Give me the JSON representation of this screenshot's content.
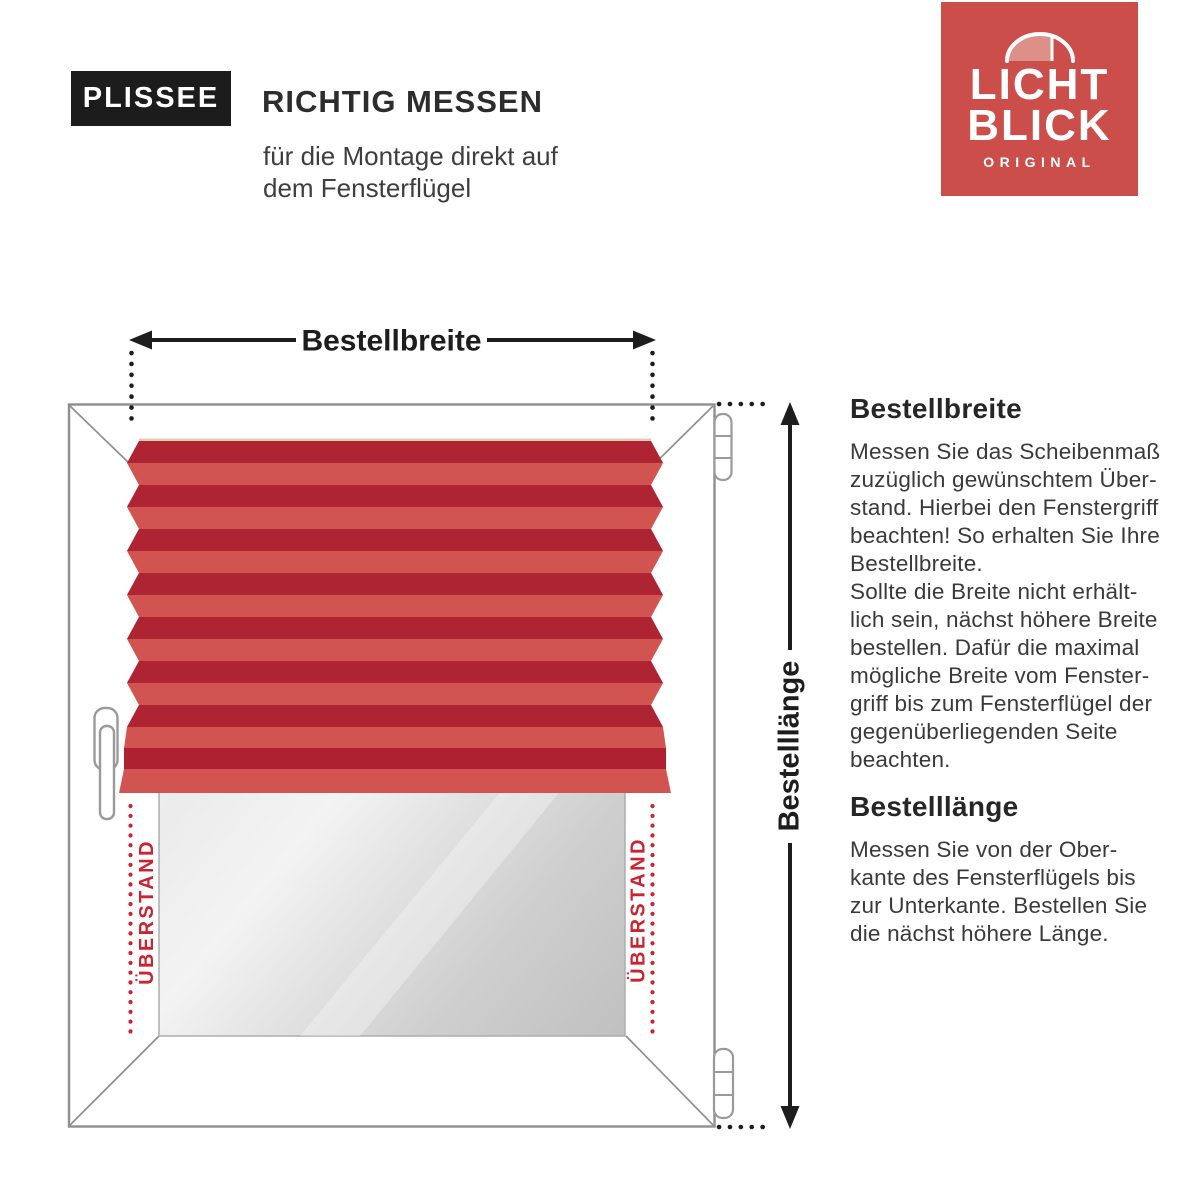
{
  "header": {
    "badge": "PLISSEE",
    "title": "RICHTIG MESSEN",
    "subtitle_lines": [
      "für die Montage direkt auf",
      "dem Fensterflügel"
    ]
  },
  "logo": {
    "word1": "LICHT",
    "word2": "BLICK",
    "tagline": "ORIGINAL",
    "bg_color": "#cb4e4a",
    "awning_color": "#dd9087"
  },
  "diagram": {
    "width_arrow_label": "Bestellbreite",
    "length_arrow_label": "Bestelllänge",
    "overhang_left_label": "ÜBERSTAND",
    "overhang_right_label": "ÜBERSTAND",
    "colors": {
      "pleat_dark": "#af2433",
      "pleat_light": "#d25450",
      "overhang_red": "#cb2430",
      "frame_gray": "#8f8f8f",
      "arrow_black": "#1d1d1d",
      "glass_light": "#f6f6f6",
      "glass_dark": "#c0c0c0"
    }
  },
  "sections": [
    {
      "heading": "Bestellbreite",
      "lines": [
        "Messen Sie das Scheibenmaß",
        "zuzüglich gewünschtem Über-",
        "stand. Hierbei den Fenstergriff",
        "beachten! So erhalten Sie Ihre",
        "Bestellbreite.",
        "Sollte die Breite nicht erhält-",
        "lich sein, nächst höhere Breite",
        "bestellen. Dafür die maximal",
        "mögliche Breite vom Fenster-",
        "griff bis zum Fensterflügel der",
        "gegenüberliegenden Seite",
        "beachten."
      ]
    },
    {
      "heading": "Bestelllänge",
      "lines": [
        "Messen Sie von der Ober-",
        "kante des Fensterflügels bis",
        "zur Unterkante. Bestellen Sie",
        "die nächst höhere Länge."
      ]
    }
  ]
}
